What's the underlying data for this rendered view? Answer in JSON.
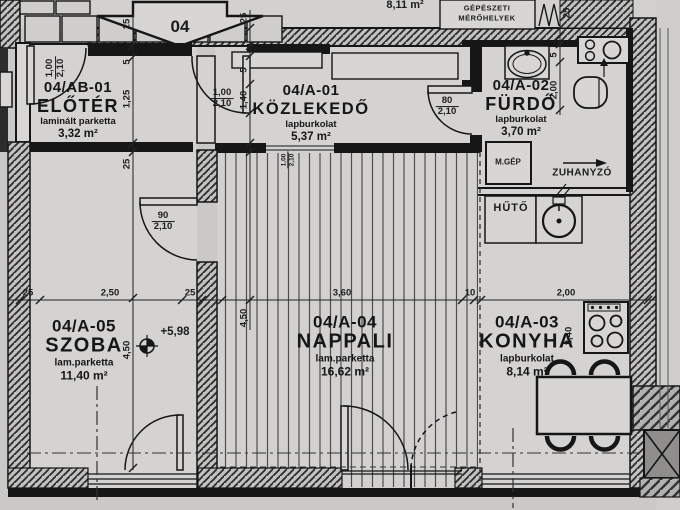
{
  "header": {
    "unit_badge": "04",
    "mech_label_line1": "GÉPÉSZETI",
    "mech_label_line2": "MÉRŐHELYEK",
    "area_above": "8,11 m²"
  },
  "rooms": [
    {
      "id": "04/AB-01",
      "name": "ELŐTÉR",
      "floor": "laminált parketta",
      "area": "3,32 m²"
    },
    {
      "id": "04/A-01",
      "name": "KÖZLEKEDŐ",
      "floor": "lapburkolat",
      "area": "5,37 m²"
    },
    {
      "id": "04/A-02",
      "name": "FÜRDŐ",
      "floor": "lapburkolat",
      "area": "3,70 m²"
    },
    {
      "id": "04/A-05",
      "name": "SZOBA",
      "floor": "lam.parketta",
      "area": "11,40 m²"
    },
    {
      "id": "04/A-04",
      "name": "NAPPALI",
      "floor": "lam.parketta",
      "area": "16,62 m²"
    },
    {
      "id": "04/A-03",
      "name": "KONYHA",
      "floor": "lapburkolat",
      "area": "8,14 m²"
    }
  ],
  "fixtures": {
    "mgep": "M.GÉP",
    "zuhanyzo": "ZUHANYZÓ",
    "huto": "HŰTŐ"
  },
  "level_mark": "+5,98",
  "dims": {
    "bottom": [
      "25",
      "2,50",
      "25",
      "3,60",
      "10",
      "2,00"
    ],
    "left_col": [
      "25",
      "5",
      "1,25",
      "25",
      "4,50"
    ],
    "mid_col": [
      "25",
      "5",
      "1,40",
      "4,50"
    ],
    "bath_col": [
      "25",
      "5",
      "2,00"
    ],
    "kitchen_depth": "2,40",
    "door_entry": {
      "w": "1,00",
      "h": "2,10"
    },
    "door_hall": {
      "w": "1,00",
      "h": "2,10"
    },
    "door_bath": {
      "w": "80",
      "h": "2,10"
    },
    "door_room": {
      "w": "90",
      "h": "2,10"
    },
    "door_living": {
      "w": "1,00",
      "h": "2,10"
    }
  },
  "colors": {
    "paper": "#cac9c7",
    "ink": "#1c1c1c"
  }
}
